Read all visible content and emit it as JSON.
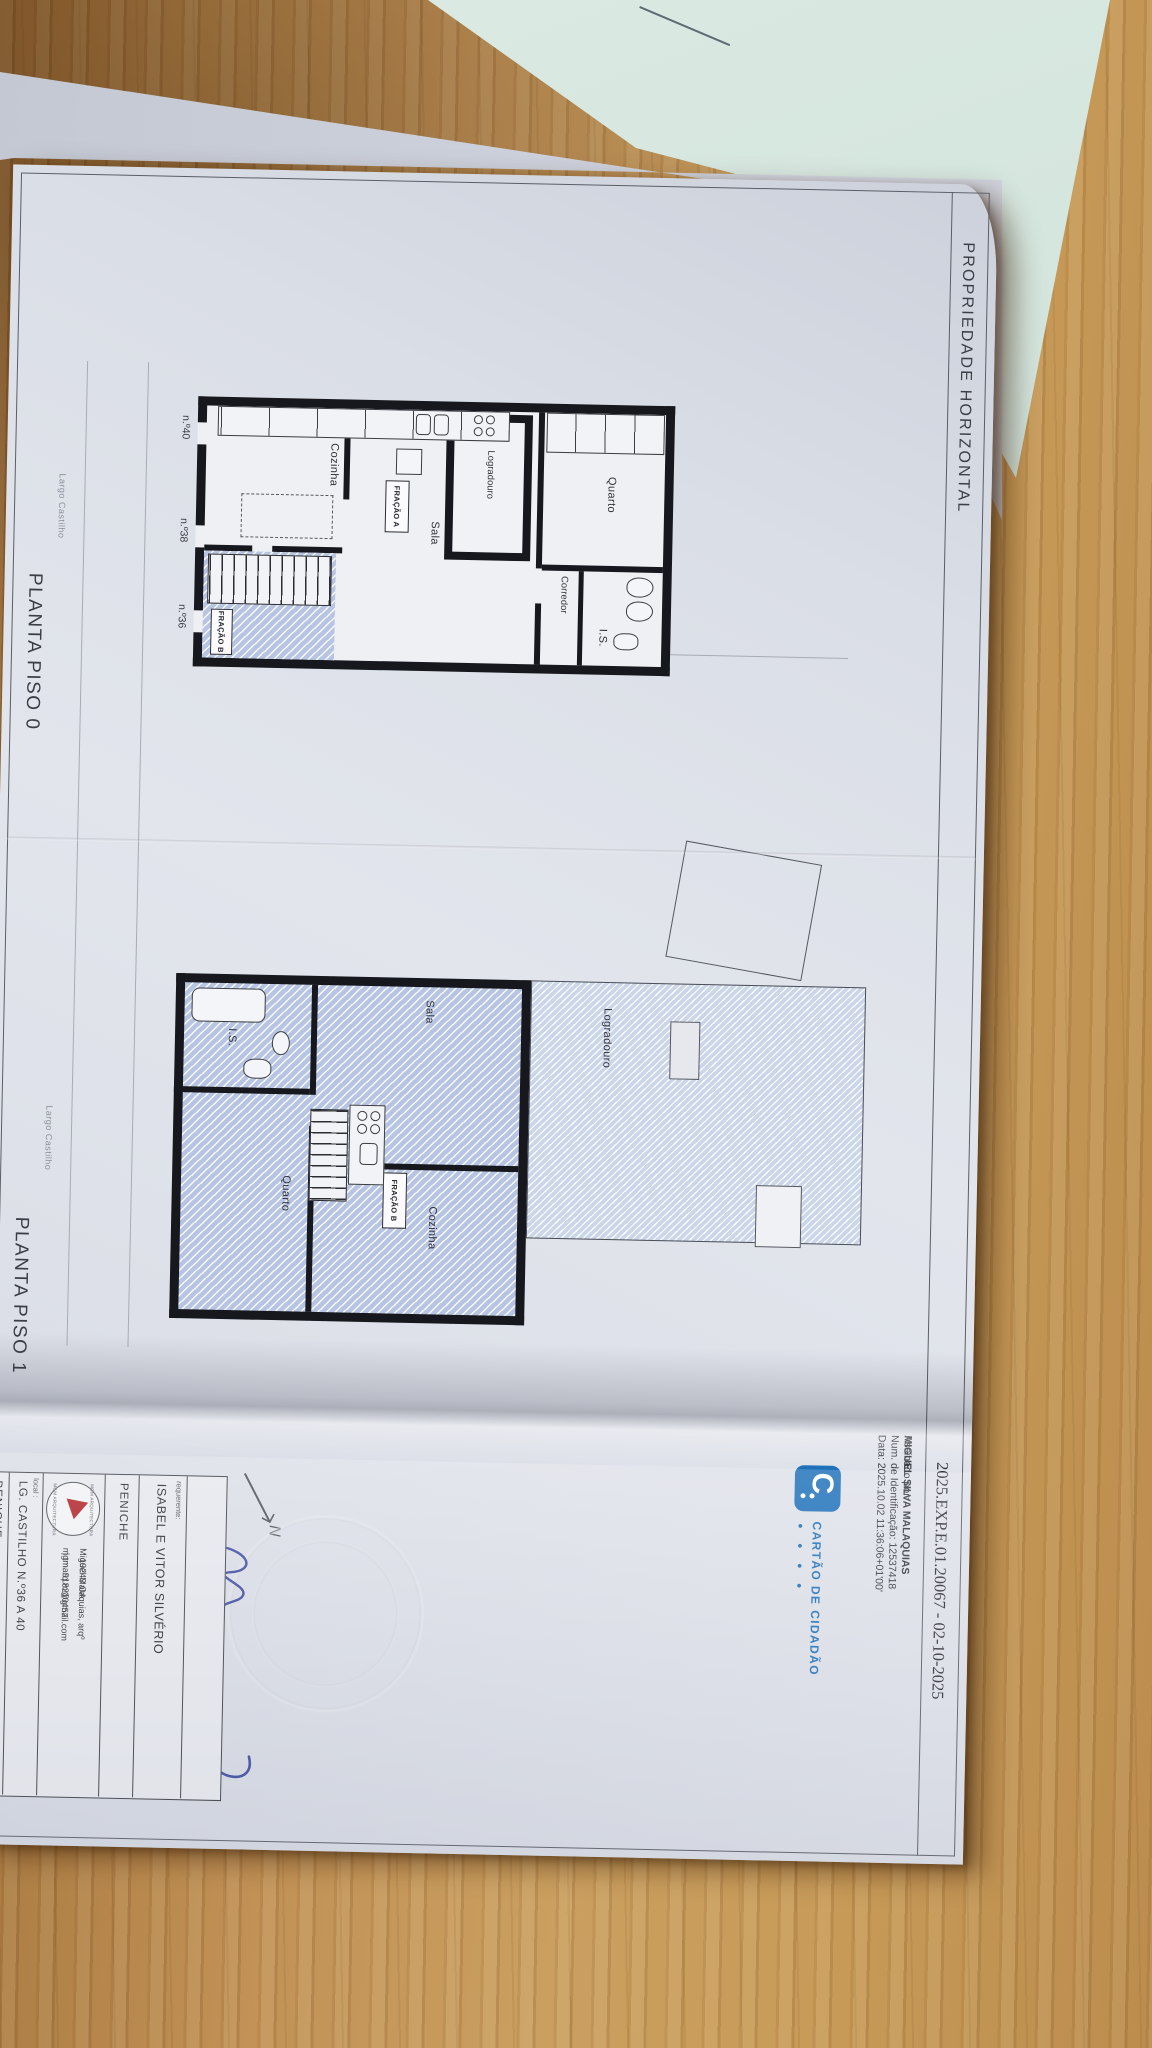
{
  "document": {
    "header": {
      "title": "PROPRIEDADE HORIZONTAL",
      "process_ref": "2025.EXP.E.01.20067 - 02-10-2025"
    },
    "digital_signature": {
      "signed_by_label": "Assinado por: ",
      "name": "MIGUEL SILVA MALAQUIAS",
      "id_line": "Num. de Identificação: 12537418",
      "date_line": "Data: 2025.10.02 11:36:06+01'00'",
      "cc_glyph": "C",
      "cc_brand": "CARTÃO DE CIDADÃO",
      "cc_dots": "● ● ● ●"
    },
    "plans": {
      "piso0": {
        "title": "PLANTA PISO 0",
        "street": "Largo Castilho",
        "rooms": {
          "quarto": "Quarto",
          "is": "I.S.",
          "corredor": "Corredor",
          "logradouro": "Logradouro",
          "sala": "Sala",
          "cozinha": "Cozinha"
        },
        "fraction_a": "FRAÇÃO A",
        "fraction_b": "FRAÇÃO B",
        "doors": [
          "n.º40",
          "n.º38",
          "n.º36"
        ]
      },
      "piso1": {
        "title": "PLANTA PISO 1",
        "street": "Largo Castilho",
        "rooms": {
          "logradouro": "Logradouro",
          "sala": "Sala",
          "cozinha": "Cozinha",
          "is": "I.S.",
          "quarto": "Quarto"
        },
        "fraction_b": "FRAÇÃO B"
      }
    },
    "north_label": "N",
    "title_block": {
      "requerente_label": "requerente:",
      "requerente": "ISABEL E VITOR SILVÉRIO",
      "municipality": "PENICHE",
      "architect": "Miguel Malaquias, arqº",
      "architect_reg": ": 19243 OA",
      "email": "mgmarq.m@gmail.com",
      "phone": "| tm. 918210457",
      "logo_text_top": "MGM ARQUITECTURA",
      "logo_text_bottom": "MGM ARQUITECTURA",
      "local_label": "local :",
      "address": "LG. CASTILHO N.º36 A 40",
      "local_value": "PENICHE"
    },
    "handwritten": {
      "date": "08/10/25"
    }
  },
  "colors": {
    "accent_blue": "#1b6fb8",
    "ink_blue": "#3a4aa0",
    "logo_red": "#b02025",
    "hatch_blue": "#b7c5e2",
    "wood": "#c09055",
    "mint_paper": "#cfe2da"
  }
}
